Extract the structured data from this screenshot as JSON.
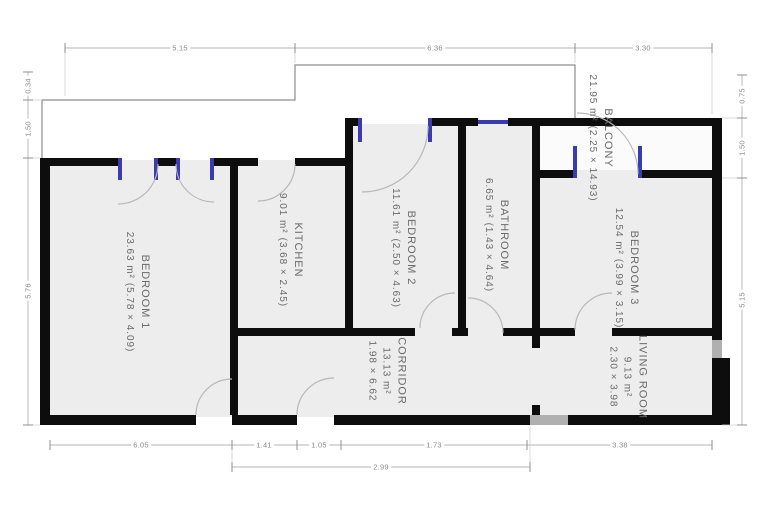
{
  "plan": {
    "rooms": [
      {
        "name": "BEDROOM 1",
        "area": "23.63 m²",
        "size": "(5.78 × 4.09)"
      },
      {
        "name": "KITCHEN",
        "area": "9.01 m²",
        "size": "(3.68 × 2.45)"
      },
      {
        "name": "BEDROOM 2",
        "area": "11.61 m²",
        "size": "(2.50 × 4.63)"
      },
      {
        "name": "BATHROOM",
        "area": "6.65 m²",
        "size": "(1.43 × 4.64)"
      },
      {
        "name": "BEDROOM 3",
        "area": "12.54 m²",
        "size": "(3.99 × 3.15)"
      },
      {
        "name": "BALCONY",
        "area": "21.95 m²",
        "size": "(2.25 × 14.93)"
      },
      {
        "name": "LIVING ROOM",
        "area": "9.13 m²",
        "size": "2.30 × 3.98"
      },
      {
        "name": "CORRIDOR",
        "area": "13.13 m²",
        "size": "1.98 × 6.62"
      }
    ],
    "dimensions": {
      "top": [
        "5.15",
        "6.36",
        "3.30"
      ],
      "left": [
        "0.34",
        "1.50",
        "5.76"
      ],
      "right": [
        "0.75",
        "1.50",
        "5.15"
      ],
      "bottom": [
        "6.05",
        "1.41",
        "1.05",
        "1.73",
        "3.38"
      ],
      "bottom_overall": "2.99"
    },
    "colors": {
      "wall": "#0d0d0d",
      "room_fill": "#ededed",
      "door_frame": "#3b3bb0",
      "dimension": "#9a9a9a",
      "label_text": "#6a6a6a"
    }
  }
}
